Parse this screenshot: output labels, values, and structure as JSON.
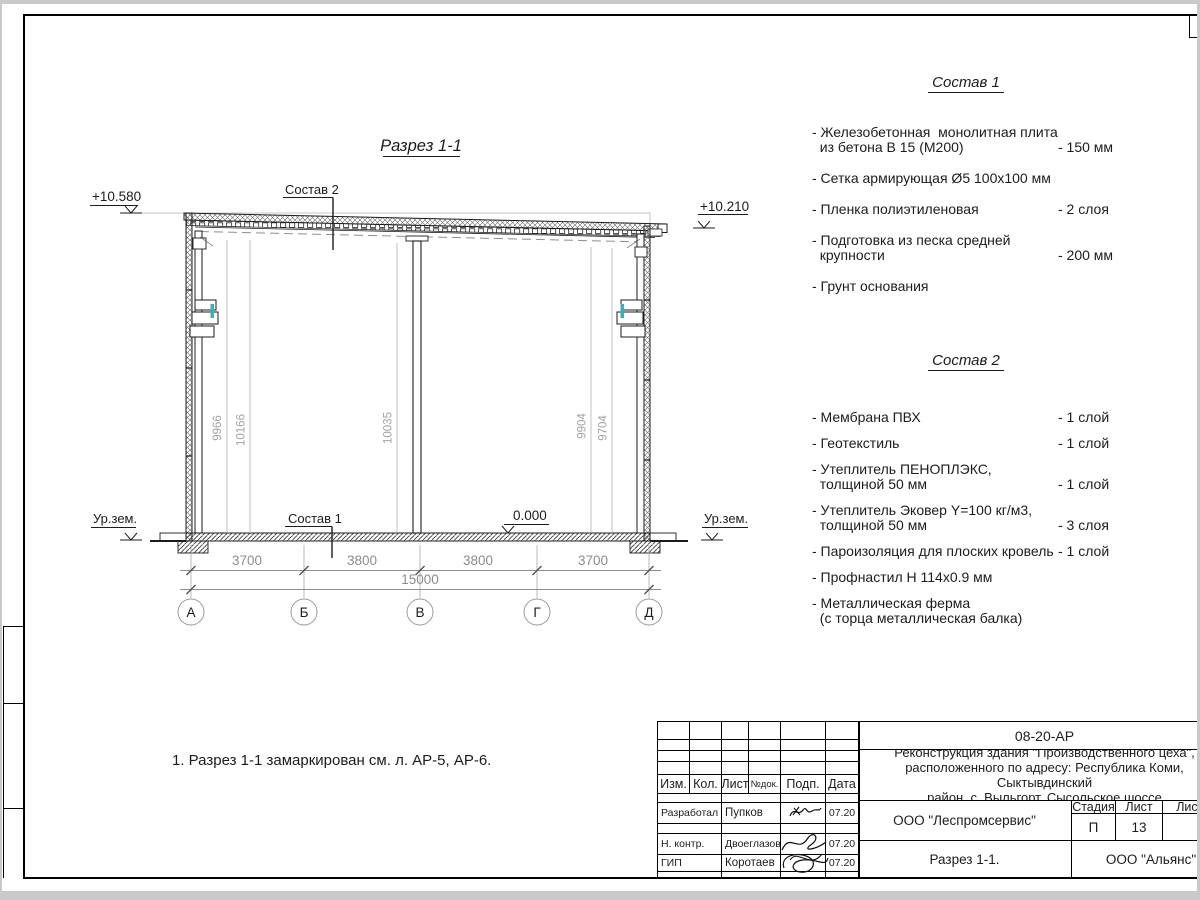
{
  "drawing": {
    "title": "Разрез 1-1",
    "elevation_left": "+10.580",
    "elevation_right": "+10.210",
    "elevation_zero": "0.000",
    "ground_label_left": "Ур.зем.",
    "ground_label_right": "Ур.зем.",
    "layer_ref_top": "Состав 2",
    "layer_ref_bottom": "Состав 1",
    "vertical_dims": [
      "9966",
      "10166",
      "10035",
      "9904",
      "9704"
    ],
    "span_dims": [
      "3700",
      "3800",
      "3800",
      "3700"
    ],
    "total_span": "15000",
    "axes": [
      "А",
      "Б",
      "В",
      "Г",
      "Д"
    ],
    "accent_color": "#2ab7bd"
  },
  "note": "1. Разрез 1-1 замаркирован см. л. АР-5, АР-6.",
  "sostav1": {
    "title": "Состав 1",
    "items": [
      {
        "name": "- Железобетонная  монолитная плита\n  из бетона В 15 (М200)",
        "value": "- 150 мм"
      },
      {
        "name": "- Сетка армирующая Ø5 100х100 мм",
        "value": ""
      },
      {
        "name": "- Пленка полиэтиленовая",
        "value": "-  2 слоя"
      },
      {
        "name": "- Подготовка из песка средней\n  крупности",
        "value": "- 200 мм"
      },
      {
        "name": "- Грунт основания",
        "value": ""
      }
    ]
  },
  "sostav2": {
    "title": "Состав 2",
    "items": [
      {
        "name": "- Мембрана ПВХ",
        "value": "- 1 слой"
      },
      {
        "name": "- Геотекстиль",
        "value": "- 1 слой"
      },
      {
        "name": "- Утеплитель ПЕНОПЛЭКС,\n  толщиной 50 мм",
        "value": "- 1 слой"
      },
      {
        "name": "- Утеплитель Эковер Y=100 кг/м3,\n  толщиной 50 мм",
        "value": "- 3 слоя"
      },
      {
        "name": "- Пароизоляция для плоских кровель",
        "value": "- 1 слой"
      },
      {
        "name": "- Профнастил Н 114х0.9 мм",
        "value": ""
      },
      {
        "name": "- Металлическая ферма\n  (с торца металлическая балка)",
        "value": ""
      }
    ]
  },
  "titleblock": {
    "doc_number": "08-20-АР",
    "project": "Реконструкция здания \"Производственного цеха\",\nрасположенного по адресу: Республика Коми, Сыктывдинский\nрайон, с. Выльгорт, Сысольское шоссе",
    "cols": {
      "izm": "Изм.",
      "kol": "Кол.",
      "list": "Лист",
      "ndok": "№док.",
      "podp": "Подп.",
      "data": "Дата"
    },
    "rows": [
      {
        "role": "Разработал",
        "name": "Пупков",
        "date": "07.20"
      },
      {
        "role": "Н. контр.",
        "name": "Двоеглазов",
        "date": "07.20"
      },
      {
        "role": "ГИП",
        "name": "Коротаев",
        "date": "07.20"
      }
    ],
    "org_design": "ООО \"Леспромсервис\"",
    "sheet_name": "Разрез 1-1.",
    "org_client": "ООО \"Альянс\"",
    "stage_header": {
      "stage": "Стадия",
      "sheet": "Лист",
      "sheets": "Листов"
    },
    "stage_values": {
      "stage": "П",
      "sheet": "13",
      "sheets": ""
    }
  }
}
